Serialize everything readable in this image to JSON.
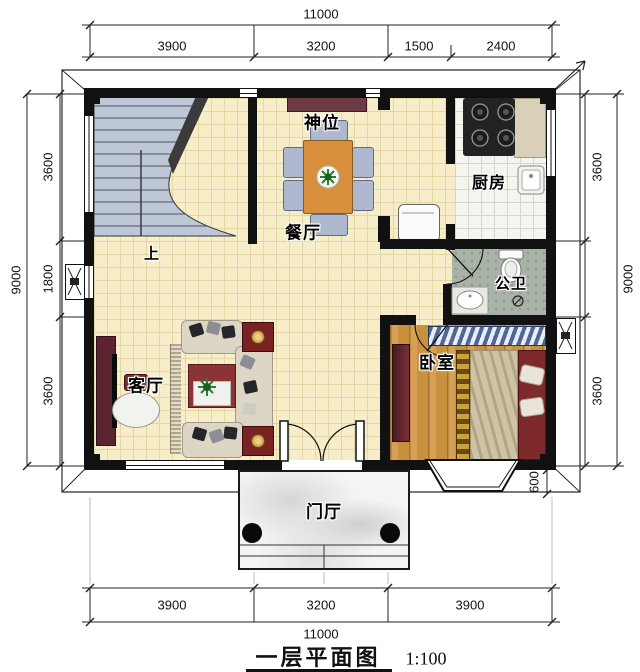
{
  "title": {
    "name": "一层平面图",
    "scale": "1:100"
  },
  "dims": {
    "top_total": "11000",
    "top_seg": [
      "3900",
      "3200",
      "1500",
      "2400"
    ],
    "bottom_seg": [
      "3900",
      "3200",
      "3900"
    ],
    "bottom_total": "11000",
    "left_total": "9000",
    "left_seg": [
      "3600",
      "1800",
      "3600"
    ],
    "right_seg": [
      "3600",
      "3600"
    ],
    "right_total": "9000",
    "porch_depth": "600"
  },
  "rooms": {
    "shrine": "神位",
    "dining": "餐厅",
    "kitchen": "厨房",
    "bath": "公卫",
    "bedroom": "卧室",
    "living": "客厅",
    "foyer": "门厅"
  },
  "stairs": {
    "up_label": "上"
  },
  "colors": {
    "wall": "#111111",
    "floor_tile": "#f7eec9",
    "stair": "#bdc7d5",
    "kitchen_tile": "#f4f4f0",
    "bath_stone": "#a9b2a6",
    "bedroom_wood": "#c9913f",
    "porch_marble": "#f4f4f4",
    "rug_red": "#8a3434",
    "sofa_beige": "#ddd6c6",
    "table_wood": "#d8903e",
    "cabinet_maroon": "#5c2430"
  }
}
